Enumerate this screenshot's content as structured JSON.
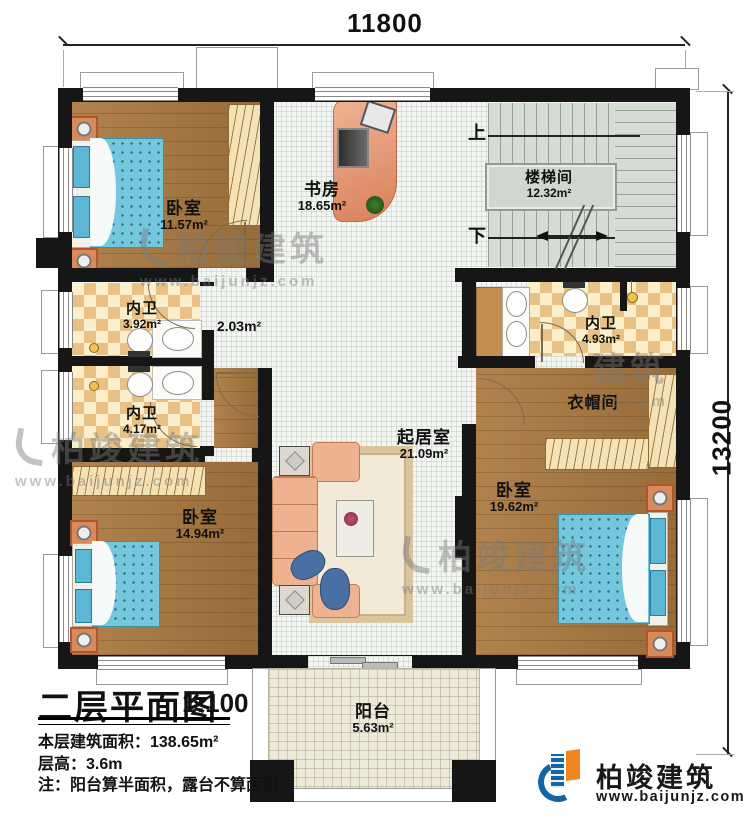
{
  "dimensions": {
    "width_label": "11800",
    "height_label": "13200"
  },
  "rooms": {
    "bedroom_top_left": {
      "name": "卧室",
      "area": "11.57m²"
    },
    "study": {
      "name": "书房",
      "area": "18.65m²"
    },
    "stairwell": {
      "name": "楼梯间",
      "area": "12.32m²",
      "up": "上",
      "down": "下"
    },
    "bath_left_top": {
      "name": "内卫",
      "area": "3.92m²"
    },
    "bath_left_bottom": {
      "name": "内卫",
      "area": "4.17m²"
    },
    "bath_right": {
      "name": "内卫",
      "area": "4.93m²"
    },
    "hallway": {
      "area": "2.03m²"
    },
    "cloakroom": {
      "name": "衣帽间"
    },
    "living_room": {
      "name": "起居室",
      "area": "21.09m²"
    },
    "bedroom_bottom_left": {
      "name": "卧室",
      "area": "14.94m²"
    },
    "bedroom_right": {
      "name": "卧室",
      "area": "19.62m²"
    },
    "balcony": {
      "name": "阳台",
      "area": "5.63m²"
    }
  },
  "title_block": {
    "title": "二层平面图",
    "scale": "1:100",
    "floor_area_line": "本层建筑面积：138.65m²",
    "floor_height_line": "层高：3.6m",
    "note_line": "注：阳台算半面积，露台不算面积"
  },
  "brand": {
    "name": "柏竣建筑",
    "url": "www.baijunjz.com"
  },
  "watermarks": {
    "name": "柏竣建筑",
    "url": "www.baijunjz.com",
    "partial_name": "建筑",
    "partial_url": "z.com"
  },
  "colors": {
    "wall": "#161616",
    "wood_floor": "#a9783f",
    "tile_floor": "#f4f6f3",
    "checker_tan": "#e9c185",
    "stair_floor": "#d7ddd6",
    "balcony_floor": "#edeadb",
    "bed_blue": "#74c7dd",
    "sofa_peach": "#eeb290",
    "brand_blue": "#1465a8",
    "brand_orange": "#f0861f",
    "brand_text": "#17181a"
  }
}
